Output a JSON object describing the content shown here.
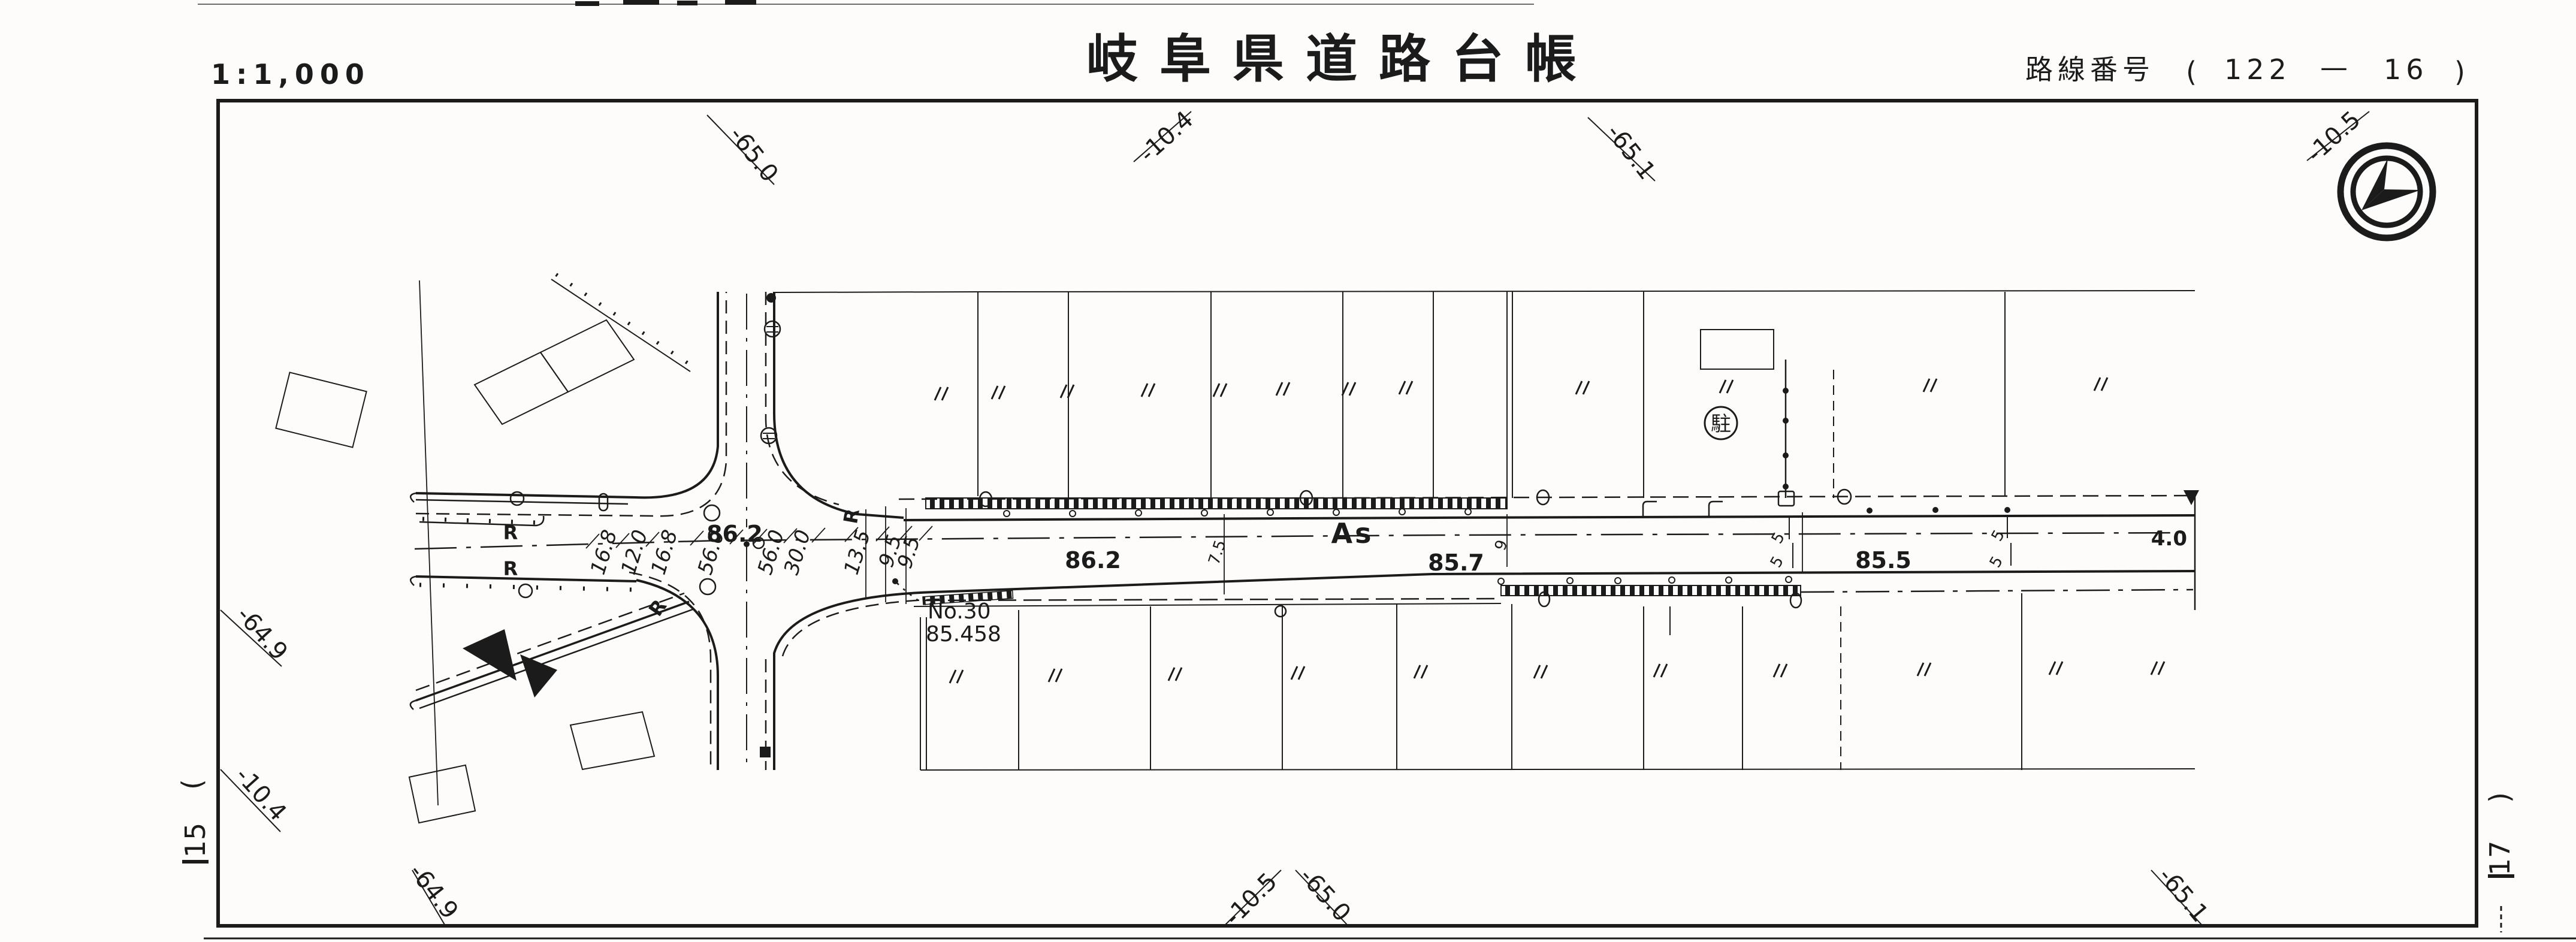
{
  "header": {
    "scale": "1:1,000",
    "title": "岐阜県道路台帳",
    "route_prefix": "路線番号",
    "route_open": "(",
    "route_number": "122",
    "route_sep": "—",
    "route_branch": "16",
    "route_close": ")"
  },
  "compass": {
    "icon": "north-arrow-compass"
  },
  "sheet_refs": {
    "left_paren": ")",
    "left_number": "15",
    "right_paren": "(",
    "right_number": "17"
  },
  "grid_labels": {
    "top_left": "-65.0",
    "top_mid": "-10.4",
    "top_right_1": "-65.1",
    "top_right_2": "-10.5",
    "left_upper": "-64.9",
    "left_lower": "-10.4",
    "bottom_left": "-64.9",
    "bottom_mid_1": "-10.5",
    "bottom_mid_2": "-65.0",
    "bottom_right": "-65.1"
  },
  "plan": {
    "surface_label": "As",
    "parking_symbol": "駐",
    "benchmark": {
      "name": "No.30",
      "elevation": "85.458"
    },
    "centerline_dims": [
      "16.8",
      "12.0",
      "16.8",
      "56.0",
      "56.0",
      "30.0",
      "13.5",
      "9.5",
      "9.5"
    ],
    "elevations": {
      "intersection": "86.2",
      "west": "86.2",
      "mid": "85.7",
      "east": "85.5",
      "end": "4.0"
    },
    "width_marks": {
      "w75": "7.5",
      "w9": "9",
      "w5a": "5",
      "w5b": "5",
      "w5c": "5",
      "w5d": "5"
    },
    "curve_labels": [
      "R",
      "R",
      "R",
      "R"
    ]
  }
}
